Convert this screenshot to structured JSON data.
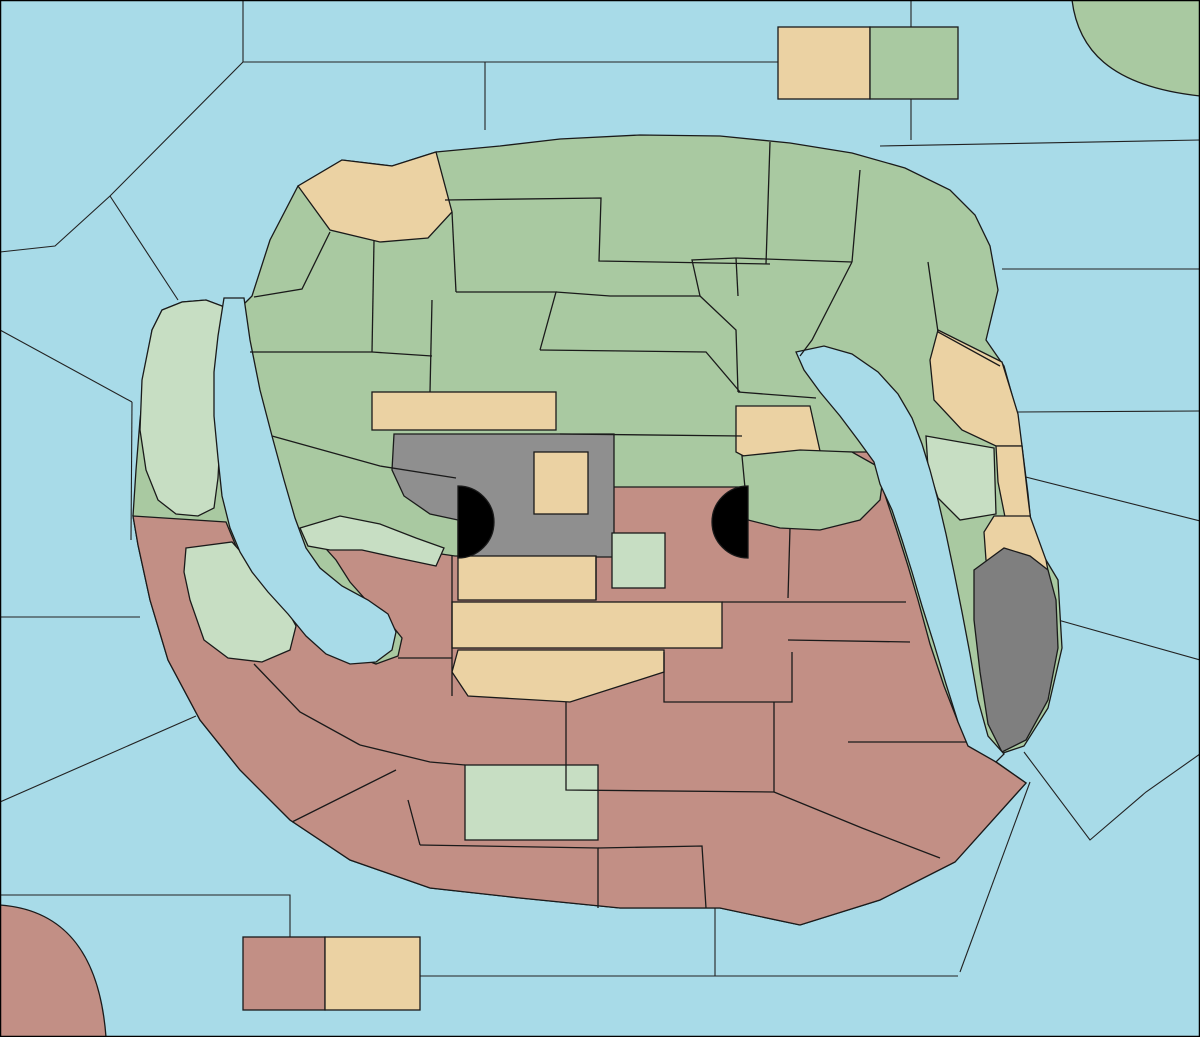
{
  "title": "Gorkion game map",
  "colors": {
    "sea": "#A8DBE8",
    "green": "#A9C9A1",
    "paleGreen": "#C7DEC3",
    "tan": "#EBD2A3",
    "red": "#C28F85",
    "gray": "#8F8F8F",
    "darkGray": "#7F7F7F",
    "arrowRed": "#C42F14",
    "arrowYellow": "#FFE52E",
    "arrowGreen": "#3FCE22",
    "arrowBlack": "#000000",
    "tankBody": "#3E9130",
    "tankTread": "#1C4A16",
    "shipHull": "#8B8B83",
    "shipWake": "#1F3C9E",
    "dislodgeDisc": "#5FA8EC",
    "burst": "#FF8C00",
    "star": "#FFE00A"
  },
  "labels": [
    {
      "t": "Nordwestmeer",
      "x": 75,
      "y": 132
    },
    {
      "t": "Polarmeer",
      "x": 404,
      "y": 32
    },
    {
      "t": "Cobaltmeer",
      "x": 562,
      "y": 98
    },
    {
      "t": "Nordostmeer",
      "x": 1035,
      "y": 112
    },
    {
      "t": "Fungali-Meer",
      "x": 240,
      "y": 173
    },
    {
      "t": "Ozean von Doom",
      "x": 1084,
      "y": 228
    },
    {
      "t": "Kamalastrasse",
      "x": 1131,
      "y": 380
    },
    {
      "t": "Teisee",
      "x": 1140,
      "y": 487
    },
    {
      "t": "Kupfer-",
      "x": 1104,
      "y": 611
    },
    {
      "t": "Küste",
      "x": 1104,
      "y": 628
    },
    {
      "t": "Altes",
      "x": 1163,
      "y": 698
    },
    {
      "t": "Meer",
      "x": 1161,
      "y": 715
    },
    {
      "t": "Golf von Pirh",
      "x": 1084,
      "y": 773
    },
    {
      "t": "Suedostmeer",
      "x": 1081,
      "y": 996
    },
    {
      "t": "Froidevaux-Meer",
      "x": 846,
      "y": 940
    },
    {
      "t": "Daxmeer",
      "x": 572,
      "y": 1009
    },
    {
      "t": "Lithiumsee",
      "x": 516,
      "y": 957
    },
    {
      "t": "Suedwestmeer",
      "x": 166,
      "y": 938
    },
    {
      "t": "Golf von Ailea",
      "x": 145,
      "y": 873
    },
    {
      "t": "Doringkanal",
      "x": 80,
      "y": 745
    },
    {
      "t": "Borkmeer",
      "x": 58,
      "y": 598
    },
    {
      "t": "Kaltes",
      "x": 62,
      "y": 366
    },
    {
      "t": "Meer",
      "x": 56,
      "y": 384
    },
    {
      "t": "Meer",
      "x": 97,
      "y": 408
    },
    {
      "t": "von Uuz",
      "x": 99,
      "y": 425
    },
    {
      "t": "Golf von",
      "x": 110,
      "y": 324
    },
    {
      "t": "Gawan",
      "x": 112,
      "y": 341
    },
    {
      "t": "Gorkion",
      "x": 239,
      "y": 391
    },
    {
      "t": "delta",
      "x": 236,
      "y": 408
    },
    {
      "t": "Mittel-",
      "x": 275,
      "y": 524
    },
    {
      "t": "gorkion",
      "x": 274,
      "y": 541
    },
    {
      "t": "Smaragd-",
      "x": 864,
      "y": 405
    },
    {
      "t": "Bucht",
      "x": 861,
      "y": 422
    },
    {
      "t": "Bucht",
      "x": 932,
      "y": 509
    },
    {
      "t": "des",
      "x": 929,
      "y": 524
    },
    {
      "t": "Ostens",
      "x": 929,
      "y": 540
    },
    {
      "t": "Rotbucht",
      "x": 337,
      "y": 630
    },
    {
      "t": "Rodesion",
      "x": 966,
      "y": 640
    },
    {
      "t": "Delta",
      "x": 963,
      "y": 657
    },
    {
      "t": "Conno",
      "x": 1152,
      "y": 77
    },
    {
      "t": "Elfland",
      "x": 822,
      "y": 85
    },
    {
      "t": "Helom",
      "x": 912,
      "y": 86
    },
    {
      "t": "Jadestadt",
      "x": 507,
      "y": 177
    },
    {
      "t": "Schloss Gruenburg",
      "x": 647,
      "y": 178
    },
    {
      "t": "Gruenheim",
      "x": 658,
      "y": 222
    },
    {
      "t": "Jossangia",
      "x": 445,
      "y": 248
    },
    {
      "t": "Qualinost",
      "x": 392,
      "y": 204
    },
    {
      "t": "Eld",
      "x": 868,
      "y": 232
    },
    {
      "t": "Caraveccia",
      "x": 785,
      "y": 275
    },
    {
      "t": "Yokai",
      "x": 708,
      "y": 294
    },
    {
      "t": "Candolti",
      "x": 300,
      "y": 301
    },
    {
      "t": "Elchen",
      "x": 448,
      "y": 307
    },
    {
      "t": "Nari",
      "x": 572,
      "y": 331
    },
    {
      "t": "Olk",
      "x": 573,
      "y": 370
    },
    {
      "t": "Tel",
      "x": 400,
      "y": 358
    },
    {
      "t": "Utar",
      "x": 872,
      "y": 320
    },
    {
      "t": "Kath",
      "x": 966,
      "y": 322
    },
    {
      "t": "Gurand",
      "x": 325,
      "y": 415
    },
    {
      "t": "Land der Wiesel",
      "x": 462,
      "y": 411
    },
    {
      "t": "Hugl",
      "x": 702,
      "y": 410
    },
    {
      "t": "Amphi",
      "x": 772,
      "y": 388
    },
    {
      "t": "Esmaladan",
      "x": 788,
      "y": 424
    },
    {
      "t": "Riesenheim",
      "x": 1015,
      "y": 371
    },
    {
      "t": "Bridon",
      "x": 954,
      "y": 419
    },
    {
      "t": "Gawan",
      "x": 178,
      "y": 397
    },
    {
      "t": "Heronn",
      "x": 165,
      "y": 479
    },
    {
      "t": "Norterend",
      "x": 496,
      "y": 457
    },
    {
      "t": "Wildall",
      "x": 618,
      "y": 457
    },
    {
      "t": "Saphirschlucht",
      "x": 372,
      "y": 505
    },
    {
      "t": "Skr",
      "x": 561,
      "y": 492
    },
    {
      "t": "Ostberg",
      "x": 645,
      "y": 495
    },
    {
      "t": "Mellar",
      "x": 790,
      "y": 502
    },
    {
      "t": "Westberg",
      "x": 538,
      "y": 543
    },
    {
      "t": "Eun",
      "x": 639,
      "y": 574
    },
    {
      "t": "Sund",
      "x": 711,
      "y": 575
    },
    {
      "t": "Obstschlucht",
      "x": 838,
      "y": 540
    },
    {
      "t": "Korbia",
      "x": 176,
      "y": 551
    },
    {
      "t": "Nabai",
      "x": 365,
      "y": 574
    },
    {
      "t": "Nogk",
      "x": 435,
      "y": 590
    },
    {
      "t": "Hills",
      "x": 500,
      "y": 579
    },
    {
      "t": "Urur",
      "x": 496,
      "y": 627
    },
    {
      "t": "Barana",
      "x": 428,
      "y": 647
    },
    {
      "t": "Arkoon",
      "x": 243,
      "y": 629
    },
    {
      "t": "Verlorenes",
      "x": 184,
      "y": 661
    },
    {
      "t": "Land",
      "x": 180,
      "y": 678
    },
    {
      "t": "Feuerfeld",
      "x": 782,
      "y": 629
    },
    {
      "t": "Chapablublek",
      "x": 525,
      "y": 673
    },
    {
      "t": "Neu Rom",
      "x": 701,
      "y": 678
    },
    {
      "t": "Pirh",
      "x": 1021,
      "y": 683
    },
    {
      "t": "Orlon",
      "x": 889,
      "y": 698
    },
    {
      "t": "Gwaul",
      "x": 1029,
      "y": 562
    },
    {
      "t": "Bynn",
      "x": 1024,
      "y": 533
    },
    {
      "t": "Qwil",
      "x": 457,
      "y": 727
    },
    {
      "t": "Nilldall",
      "x": 576,
      "y": 749
    },
    {
      "t": "Kaaldewaa",
      "x": 659,
      "y": 764
    },
    {
      "t": "Kentommenai",
      "x": 259,
      "y": 764
    },
    {
      "t": "Charaua",
      "x": 327,
      "y": 725
    },
    {
      "t": "Sottovia",
      "x": 418,
      "y": 800
    },
    {
      "t": "Rotheim",
      "x": 506,
      "y": 822
    },
    {
      "t": "Mouchimoglou",
      "x": 679,
      "y": 823
    },
    {
      "t": "Zinnoberburg",
      "x": 447,
      "y": 868
    },
    {
      "t": "Karminstadt",
      "x": 690,
      "y": 887
    },
    {
      "t": "Samyria",
      "x": 806,
      "y": 857
    },
    {
      "t": "Losteria",
      "x": 884,
      "y": 795
    },
    {
      "t": "Ailea",
      "x": 343,
      "y": 849
    },
    {
      "t": "Corws",
      "x": 51,
      "y": 1013
    },
    {
      "t": "Abaun",
      "x": 289,
      "y": 990
    },
    {
      "t": "Ornheim",
      "x": 372,
      "y": 990
    },
    {
      "t": "(wc)",
      "x": 142,
      "y": 418,
      "s": 1
    },
    {
      "t": "(ec)",
      "x": 210,
      "y": 479,
      "s": 1
    },
    {
      "t": "(ec)",
      "x": 225,
      "y": 530,
      "s": 1
    },
    {
      "t": "(wc)",
      "x": 140,
      "y": 572,
      "s": 1
    },
    {
      "t": "(wc)",
      "x": 986,
      "y": 536,
      "s": 1
    },
    {
      "t": "(wc)",
      "x": 999,
      "y": 585,
      "s": 1
    },
    {
      "t": "(ec)",
      "x": 1058,
      "y": 465,
      "s": 1
    },
    {
      "t": "(ec)",
      "x": 1050,
      "y": 621,
      "s": 1
    }
  ],
  "supply_centers": [
    [
      1186,
      10
    ],
    [
      942,
      41
    ],
    [
      448,
      160
    ],
    [
      628,
      154
    ],
    [
      696,
      248
    ],
    [
      258,
      272
    ],
    [
      517,
      363
    ],
    [
      732,
      333
    ],
    [
      1008,
      334
    ],
    [
      421,
      450
    ],
    [
      198,
      427
    ],
    [
      752,
      490
    ],
    [
      973,
      481
    ],
    [
      231,
      564
    ],
    [
      421,
      546
    ],
    [
      188,
      707
    ],
    [
      460,
      697
    ],
    [
      688,
      540
    ],
    [
      685,
      589
    ],
    [
      1002,
      606
    ],
    [
      813,
      675
    ],
    [
      948,
      762
    ],
    [
      255,
      952
    ],
    [
      7,
      1026
    ],
    [
      494,
      778
    ],
    [
      572,
      880
    ],
    [
      743,
      869
    ]
  ],
  "capital_star": {
    "x": 689,
    "y": 149
  },
  "units": {
    "armies": [
      {
        "x": 172,
        "y": 455
      },
      {
        "x": 173,
        "y": 372,
        "m": "diamonds"
      },
      {
        "x": 445,
        "y": 470
      },
      {
        "x": 515,
        "y": 525
      },
      {
        "x": 672,
        "y": 456
      },
      {
        "x": 782,
        "y": 370
      },
      {
        "x": 674,
        "y": 525,
        "m": "burst"
      },
      {
        "x": 633,
        "y": 551
      },
      {
        "x": 835,
        "y": 480
      },
      {
        "x": 967,
        "y": 460
      },
      {
        "x": 872,
        "y": 563
      },
      {
        "x": 966,
        "y": 288,
        "m": "dislodged"
      },
      {
        "x": 355,
        "y": 553
      },
      {
        "x": 400,
        "y": 605
      },
      {
        "x": 307,
        "y": 690
      },
      {
        "x": 418,
        "y": 777
      },
      {
        "x": 557,
        "y": 806
      },
      {
        "x": 1020,
        "y": 664
      }
    ],
    "fleets": [
      {
        "x": 268,
        "y": 152,
        "b": "green"
      },
      {
        "x": 653,
        "y": 100,
        "b": "green"
      },
      {
        "x": 672,
        "y": 158
      },
      {
        "x": 117,
        "y": 275,
        "b": "red"
      },
      {
        "x": 222,
        "y": 368,
        "b": "green"
      },
      {
        "x": 263,
        "y": 500,
        "b": "green"
      },
      {
        "x": 1030,
        "y": 196,
        "b": "green"
      },
      {
        "x": 1121,
        "y": 347,
        "b": "red"
      },
      {
        "x": 890,
        "y": 447,
        "b": "red"
      },
      {
        "x": 510,
        "y": 877
      }
    ]
  },
  "arrows": [
    {
      "c": "red",
      "p": [
        [
          480,
          33
        ],
        [
          288,
          140
        ]
      ],
      "h": "end"
    },
    {
      "c": "red",
      "p": [
        [
          268,
          162
        ],
        [
          233,
          348
        ]
      ],
      "h": "end"
    },
    {
      "c": "red",
      "p": [
        [
          1042,
          80
        ],
        [
          703,
          98
        ]
      ],
      "h": "end"
    },
    {
      "c": "red",
      "p": [
        [
          1032,
          206
        ],
        [
          1112,
          322
        ]
      ],
      "h": "end"
    },
    {
      "c": "red",
      "p": [
        [
          1108,
          338
        ],
        [
          992,
          295
        ]
      ],
      "h": "end"
    },
    {
      "c": "red",
      "p": [
        [
          980,
          302
        ],
        [
          1116,
          346
        ]
      ],
      "h": "none"
    },
    {
      "c": "red",
      "p": [
        [
          122,
          287
        ],
        [
          166,
          357
        ]
      ],
      "h": "end"
    },
    {
      "c": "red",
      "p": [
        [
          305,
          374
        ],
        [
          192,
          373
        ]
      ],
      "h": "end"
    },
    {
      "c": "red",
      "p": [
        [
          622,
          408
        ],
        [
          662,
          448
        ]
      ],
      "h": "end"
    },
    {
      "c": "red",
      "p": [
        [
          733,
          312
        ],
        [
          777,
          358
        ]
      ],
      "h": "end"
    },
    {
      "c": "red",
      "p": [
        [
          755,
          580
        ],
        [
          693,
          535
        ]
      ],
      "h": "end"
    },
    {
      "c": "red",
      "p": [
        [
          718,
          562
        ],
        [
          700,
          545
        ]
      ],
      "h": "none"
    },
    {
      "c": "red",
      "p": [
        [
          868,
          556
        ],
        [
          841,
          492
        ]
      ],
      "h": "end"
    },
    {
      "c": "red",
      "p": [
        [
          874,
          514
        ],
        [
          886,
          554
        ]
      ],
      "h": "none"
    },
    {
      "c": "red",
      "p": [
        [
          937,
          576
        ],
        [
          899,
          469
        ]
      ],
      "h": "end"
    },
    {
      "c": "red",
      "p": [
        [
          309,
          684
        ],
        [
          243,
          610
        ]
      ],
      "h": "end"
    },
    {
      "c": "red",
      "p": [
        [
          262,
          512
        ],
        [
          240,
          594
        ]
      ],
      "h": "end"
    },
    {
      "c": "red",
      "p": [
        [
          320,
          831
        ],
        [
          410,
          783
        ]
      ],
      "h": "end"
    },
    {
      "c": "red",
      "p": [
        [
          425,
          778
        ],
        [
          542,
          805
        ]
      ],
      "h": "end"
    },
    {
      "c": "red",
      "p": [
        [
          397,
          599
        ],
        [
          365,
          564
        ]
      ],
      "h": "end"
    },
    {
      "c": "yellow",
      "p": [
        [
          176,
          451
        ],
        [
          198,
          396
        ]
      ],
      "h": "end"
    },
    {
      "c": "yellow",
      "p": [
        [
          178,
          453
        ],
        [
          211,
          403
        ]
      ],
      "h": "none"
    },
    {
      "c": "yellow",
      "p": [
        [
          350,
          554
        ],
        [
          263,
          564
        ]
      ],
      "h": "end"
    },
    {
      "c": "yellow",
      "p": [
        [
          350,
          558
        ],
        [
          295,
          573
        ]
      ],
      "h": "none"
    },
    {
      "c": "yellow",
      "p": [
        [
          634,
          551
        ],
        [
          676,
          539
        ]
      ],
      "h": "end"
    },
    {
      "c": "yellow",
      "p": [
        [
          636,
          554
        ],
        [
          674,
          550
        ]
      ],
      "h": "none"
    },
    {
      "c": "yellow",
      "p": [
        [
          634,
          551
        ],
        [
          655,
          575
        ]
      ],
      "h": "none"
    },
    {
      "c": "green",
      "p": [
        [
          845,
          477
        ],
        [
          955,
          461
        ]
      ],
      "h": "end"
    },
    {
      "c": "black",
      "p": [
        [
          230,
          338
        ],
        [
          209,
          337
        ]
      ],
      "h": "end"
    },
    {
      "c": "black",
      "p": [
        [
          303,
          555
        ],
        [
          251,
          554
        ]
      ],
      "h": "end"
    },
    {
      "c": "black",
      "p": [
        [
          818,
          402
        ],
        [
          842,
          381
        ]
      ],
      "h": "both"
    },
    {
      "c": "black",
      "p": [
        [
          893,
          481
        ],
        [
          948,
          482
        ]
      ],
      "h": "both"
    },
    {
      "c": "black",
      "p": [
        [
          360,
          651
        ],
        [
          386,
          629
        ]
      ],
      "h": "both"
    },
    {
      "c": "black",
      "p": [
        [
          960,
          698
        ],
        [
          994,
          698
        ]
      ],
      "h": "both"
    }
  ],
  "fail_marks": [
    {
      "x": 134,
      "y": 307,
      "r": 14,
      "c": "red"
    },
    {
      "x": 1057,
      "y": 253,
      "r": 14,
      "c": "red"
    },
    {
      "x": 1070,
      "y": 327,
      "r": 16,
      "c": "red"
    },
    {
      "x": 245,
      "y": 530,
      "r": 15,
      "c": "red"
    },
    {
      "x": 313,
      "y": 557,
      "r": 15,
      "c": "red"
    },
    {
      "x": 389,
      "y": 588,
      "r": 14,
      "c": "red"
    },
    {
      "x": 284,
      "y": 662,
      "r": 15,
      "c": "red"
    },
    {
      "x": 865,
      "y": 532,
      "r": 14,
      "c": "red"
    },
    {
      "x": 235,
      "y": 603,
      "r": 21,
      "c": "red"
    },
    {
      "x": 858,
      "y": 471,
      "r": 13,
      "c": "green"
    }
  ]
}
